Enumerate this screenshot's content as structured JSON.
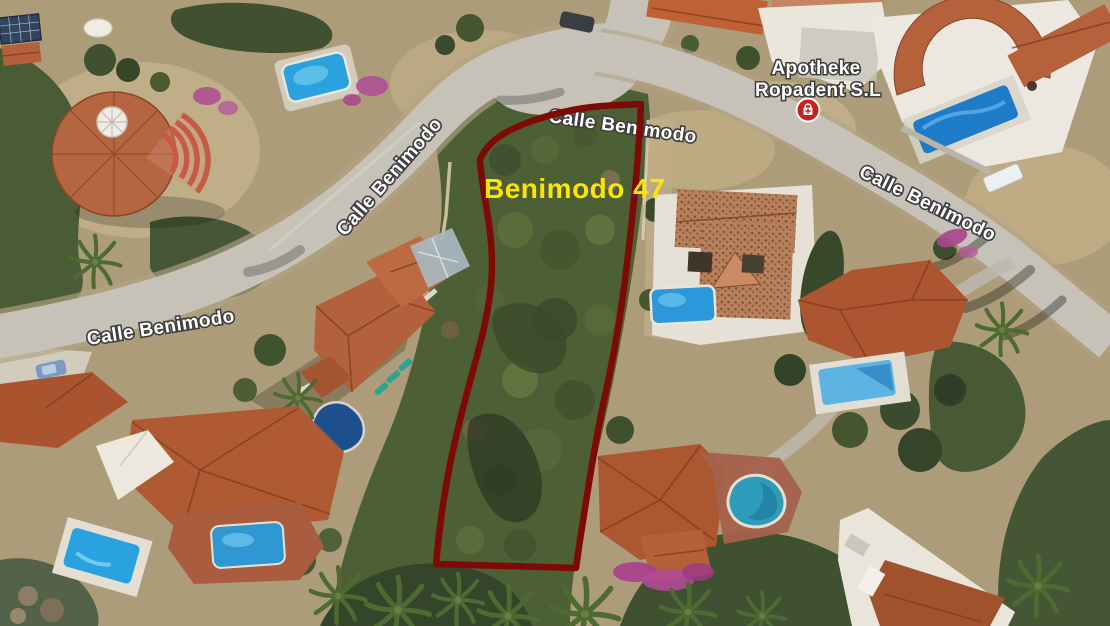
{
  "map": {
    "parcel": {
      "label": "Benimodo 47",
      "label_color": "#ffe400",
      "outline_color": "#7d0a04"
    },
    "streets": [
      {
        "name": "Calle Benimodo"
      },
      {
        "name": "Calle Benimodo"
      },
      {
        "name": "Calle Benimodo"
      },
      {
        "name": "Calle Benimodo"
      }
    ],
    "poi": {
      "name": "Apotheke",
      "subname": "Ropadent S.L",
      "marker_color": "#c5221f",
      "marker_icon": "pharmacy-bag-icon"
    }
  }
}
